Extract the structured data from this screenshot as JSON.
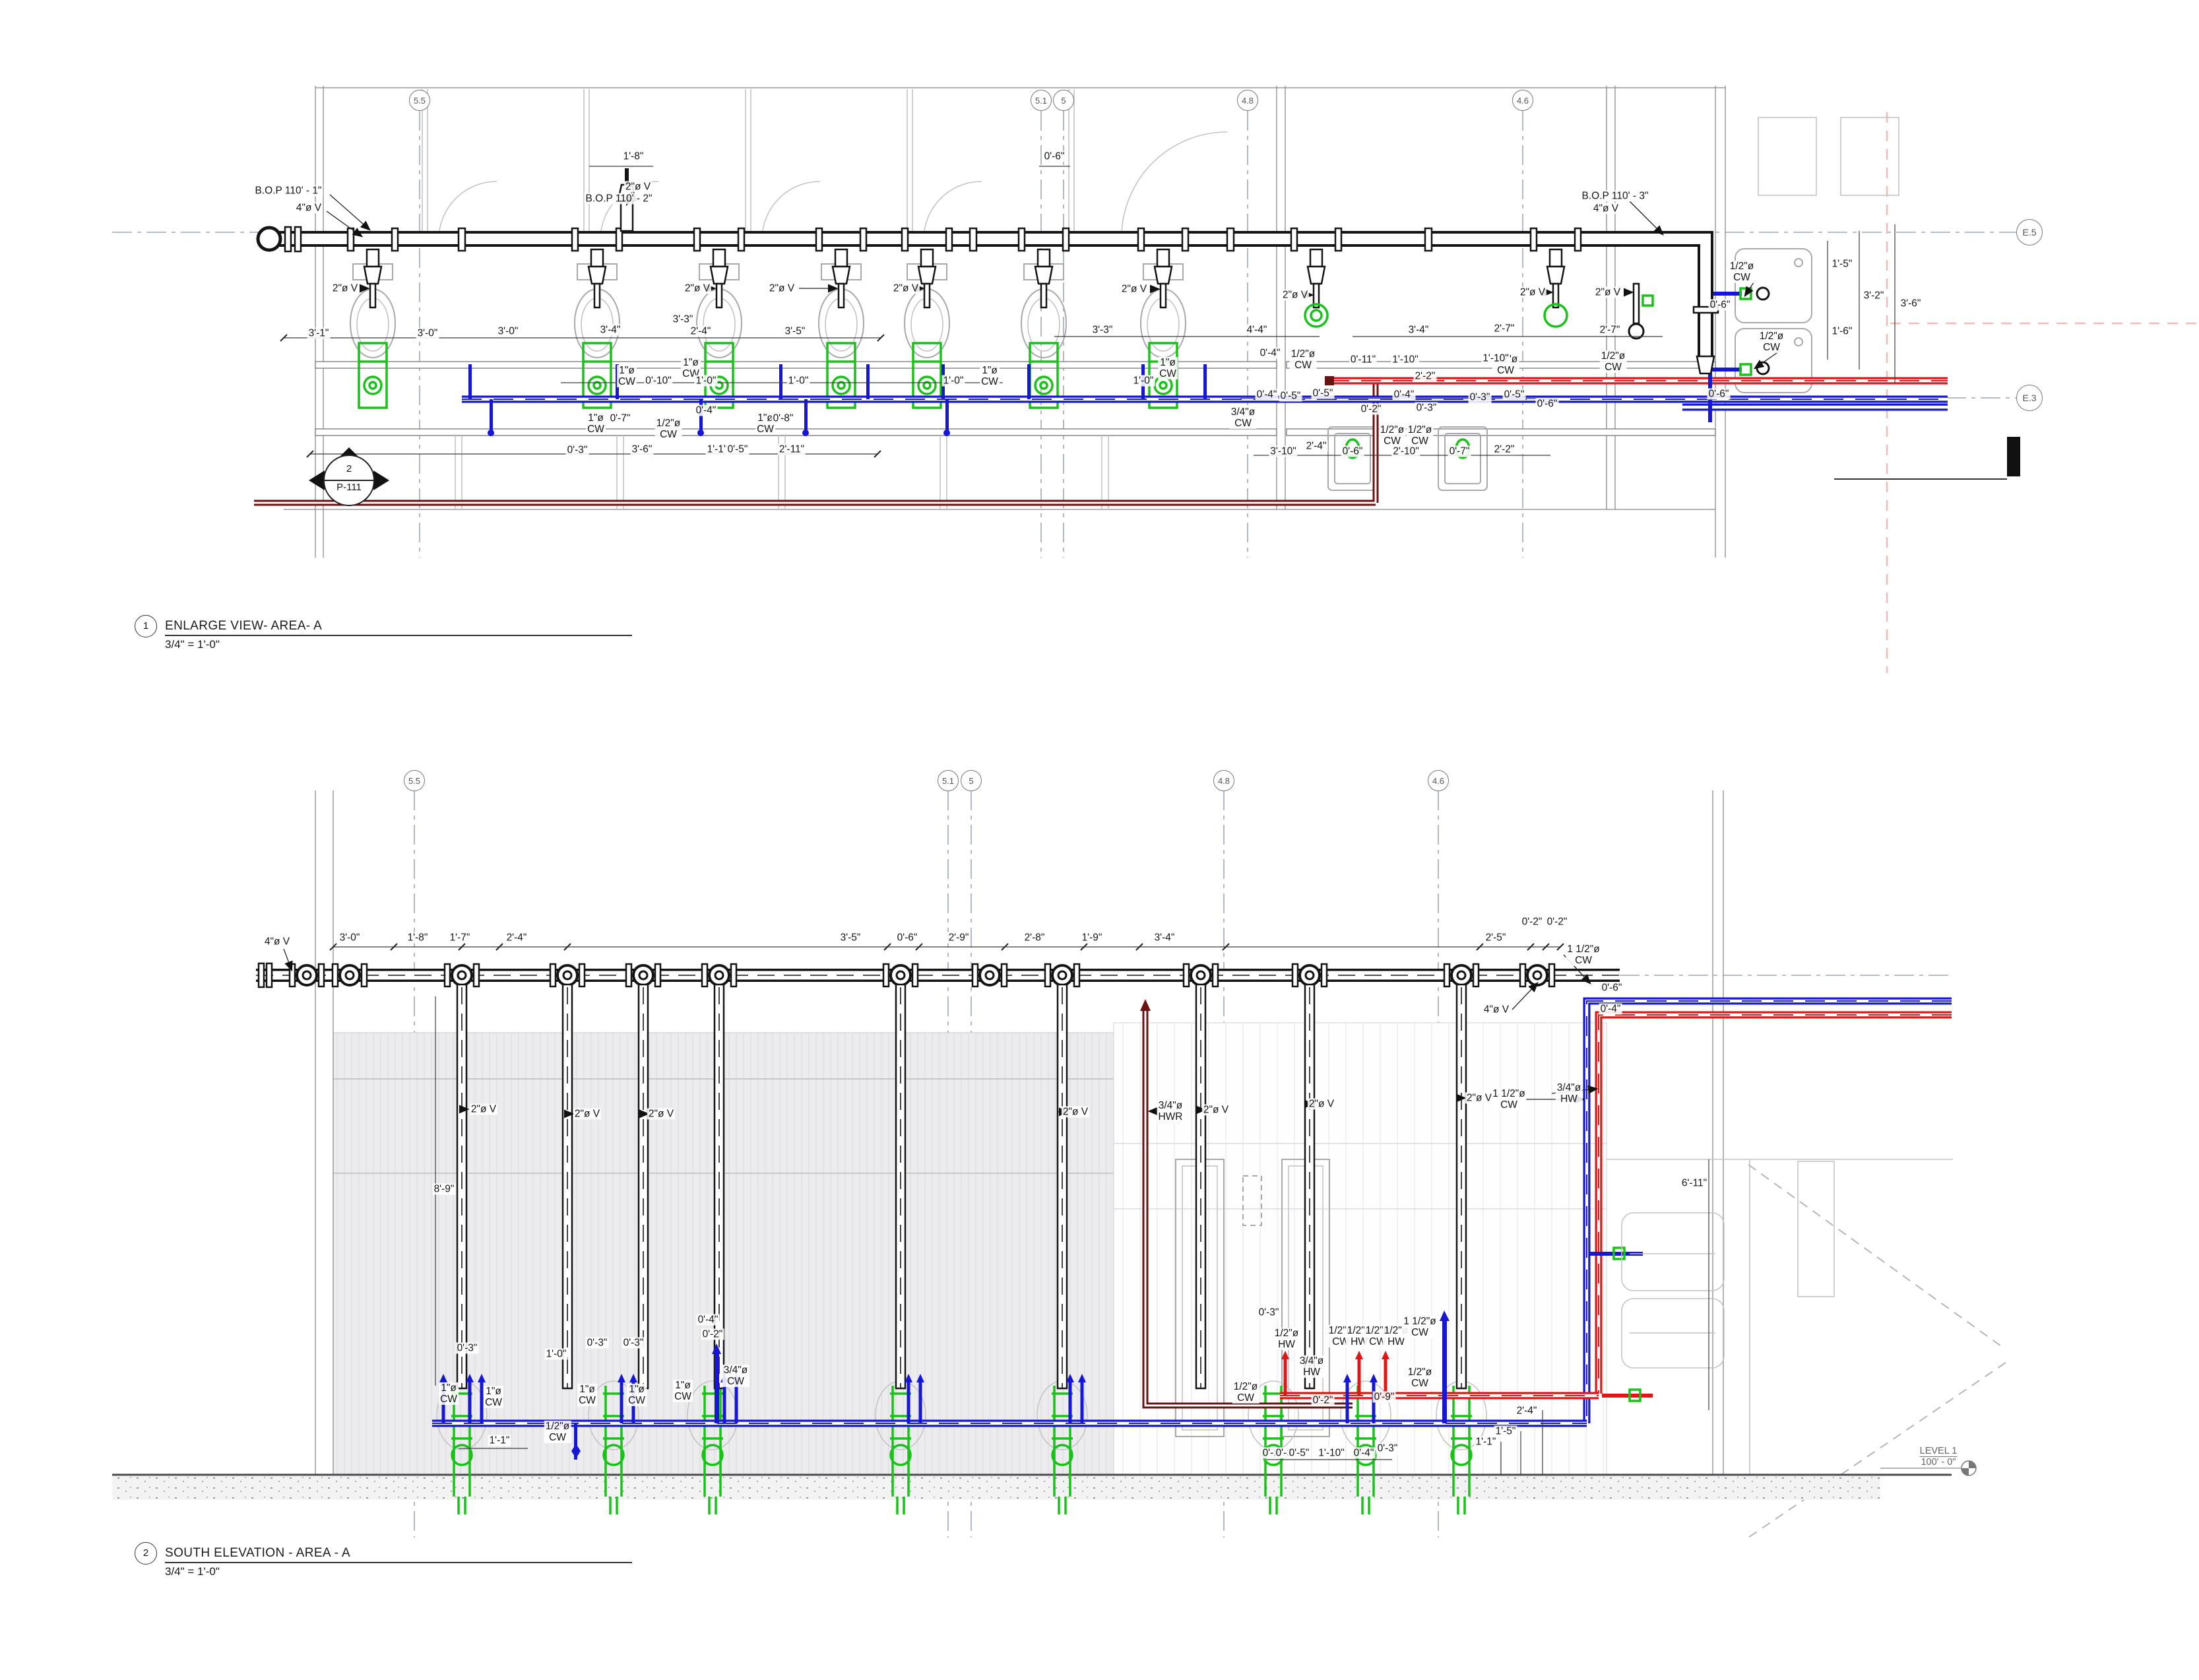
{
  "drawing": {
    "type": "plumbing-shop-drawing",
    "colors": {
      "cold_water": "#1616d6",
      "hot_water": "#e31616",
      "hot_water_return": "#6d1212",
      "vent": "#141414",
      "fixture_carrier": "#16c316",
      "grid": "#8a93a6"
    },
    "views": [
      {
        "id": "plan",
        "number": "1",
        "title": "ENLARGE VIEW- AREA- A",
        "scale": "3/4\" = 1'-0\"",
        "grid_bubbles": [
          [
            "5.5",
            636,
            152
          ],
          [
            "5.1",
            1578,
            152
          ],
          [
            "5",
            1612,
            152
          ],
          [
            "4.8",
            1891,
            152
          ],
          [
            "4.6",
            2308,
            152
          ],
          [
            "E.5",
            3076,
            352,
            19
          ],
          [
            "E.3",
            3076,
            603,
            19
          ]
        ],
        "section_tag": {
          "number": "2",
          "sheet": "P-111"
        },
        "labels": [
          [
            "B.O.P 110' - 1\"",
            437,
            289
          ],
          [
            "4\"ø V",
            468,
            315
          ],
          [
            "2\"ø V",
            523,
            437
          ],
          [
            "3'-1\"",
            483,
            505
          ],
          [
            "3'-0\"",
            648,
            505
          ],
          [
            "1'-8\"",
            960,
            237
          ],
          [
            "2\"ø V",
            967,
            283
          ],
          [
            "B.O.P 110' - 2\"",
            938,
            301
          ],
          [
            "2\"ø V",
            1057,
            437
          ],
          [
            "2\"ø V",
            1185,
            437
          ],
          [
            "2\"ø V",
            1373,
            437
          ],
          [
            "2\"ø V",
            1719,
            438
          ],
          [
            "2\"ø V",
            1963,
            447
          ],
          [
            "2\"ø V",
            2323,
            443
          ],
          [
            "2\"ø V",
            2437,
            443
          ],
          [
            "3'-0\"",
            770,
            502
          ],
          [
            "3'-4\"",
            925,
            500
          ],
          [
            "3'-3\"",
            1035,
            484
          ],
          [
            "2'-4\"",
            1062,
            502
          ],
          [
            "3'-5\"",
            1205,
            502
          ],
          [
            "0'-6\"",
            1598,
            237
          ],
          [
            "3'-3\"",
            1671,
            500
          ],
          [
            "4'-4\"",
            1905,
            500
          ],
          [
            "3'-4\"",
            2150,
            500
          ],
          [
            "2'-7\"",
            2280,
            498
          ],
          [
            "1\"ø\nCW",
            950,
            570
          ],
          [
            "0'-10\"",
            998,
            577
          ],
          [
            "1\"ø\nCW",
            1047,
            558
          ],
          [
            "1'-0\"",
            1070,
            577
          ],
          [
            "1'-0\"",
            1210,
            577
          ],
          [
            "1\"ø\nCW",
            1500,
            570
          ],
          [
            "1'-0\"",
            1445,
            577
          ],
          [
            "1\"ø\nCW",
            1770,
            558
          ],
          [
            "1'-0\"",
            1733,
            577
          ],
          [
            "1\"ø\nCW",
            903,
            642
          ],
          [
            "0'-7\"",
            940,
            634
          ],
          [
            "1/2\"ø\nCW",
            1013,
            650
          ],
          [
            "0'-4\"",
            1070,
            622
          ],
          [
            "1\"ø\nCW",
            1160,
            642
          ],
          [
            "0'-8\"",
            1187,
            634
          ],
          [
            "0'-3\"",
            875,
            682
          ],
          [
            "3'-6\"",
            973,
            681
          ],
          [
            "1'-1\"",
            1087,
            681
          ],
          [
            "0'-5\"",
            1118,
            681
          ],
          [
            "2'-11\"",
            1200,
            681
          ],
          [
            "0'-5\"",
            1956,
            600
          ],
          [
            "0'-4\"",
            1925,
            535
          ],
          [
            "1/2\"ø\nCW",
            1975,
            545
          ],
          [
            "0'-11\"",
            2066,
            545
          ],
          [
            "1'-10\"",
            2130,
            545
          ],
          [
            "2'-2\"",
            2160,
            570
          ],
          [
            "1/2\"ø\nCW",
            2282,
            553
          ],
          [
            "0'-4\"",
            1920,
            598
          ],
          [
            "0'-5\"",
            2005,
            596
          ],
          [
            "0'-4\"",
            2128,
            598
          ],
          [
            "0'-3\"",
            2243,
            602
          ],
          [
            "0'-5\"",
            2295,
            598
          ],
          [
            "0'-6\"",
            2345,
            612
          ],
          [
            "3/4\"ø\nCW",
            1884,
            633
          ],
          [
            "0'-2\"",
            2078,
            620
          ],
          [
            "0'-3\"",
            2162,
            618
          ],
          [
            "1/2\"ø\nCW",
            2110,
            660
          ],
          [
            "1/2\"ø\nCW",
            2152,
            660
          ],
          [
            "3'-10\"",
            1945,
            684
          ],
          [
            "2'-4\"",
            1995,
            676
          ],
          [
            "0'-6\"",
            2050,
            684
          ],
          [
            "2'-10\"",
            2131,
            684
          ],
          [
            "0'-7\"",
            2212,
            684
          ],
          [
            "2'-2\"",
            2280,
            681
          ],
          [
            "B.O.P 110' - 3\"",
            2448,
            297
          ],
          [
            "4\"ø V",
            2434,
            316
          ],
          [
            "2'-7\"",
            2440,
            500
          ],
          [
            "1'-10\"",
            2267,
            543
          ],
          [
            "1/2\"ø\nCW",
            2445,
            548
          ],
          [
            "1/2\"ø\nCW",
            2640,
            412
          ],
          [
            "1/2\"ø\nCW",
            2685,
            518
          ],
          [
            "1'-5\"",
            2792,
            400
          ],
          [
            "3'-2\"",
            2840,
            448
          ],
          [
            "3'-6\"",
            2896,
            460
          ],
          [
            "1'-6\"",
            2792,
            502
          ],
          [
            "0'-6\"",
            2607,
            462
          ],
          [
            "0'-6\"",
            2605,
            597
          ]
        ]
      },
      {
        "id": "elevation",
        "number": "2",
        "title": "SOUTH ELEVATION - AREA - A",
        "scale": "3/4\" = 1'-0\"",
        "grid_bubbles": [
          [
            "5.5",
            628,
            1183
          ],
          [
            "5.1",
            1437,
            1183
          ],
          [
            "5",
            1472,
            1183
          ],
          [
            "4.8",
            1855,
            1183
          ],
          [
            "4.6",
            2180,
            1183
          ]
        ],
        "level_tag": {
          "name": "LEVEL 1",
          "elevation": "100' - 0\""
        },
        "labels": [
          [
            "4\"ø V",
            420,
            1427
          ],
          [
            "3'-0\"",
            530,
            1421
          ],
          [
            "1'-8\"",
            633,
            1421
          ],
          [
            "1'-7\"",
            697,
            1421
          ],
          [
            "2'-4\"",
            783,
            1421
          ],
          [
            "3'-5\"",
            1289,
            1421
          ],
          [
            "0'-6\"",
            1375,
            1421
          ],
          [
            "2'-9\"",
            1453,
            1421
          ],
          [
            "2'-8\"",
            1568,
            1421
          ],
          [
            "1'-9\"",
            1655,
            1421
          ],
          [
            "3'-4\"",
            1765,
            1421
          ],
          [
            "2'-5\"",
            2267,
            1421
          ],
          [
            "0'-2\"",
            2322,
            1397
          ],
          [
            "0'-2\"",
            2360,
            1397
          ],
          [
            "1 1/2\"ø\nCW",
            2400,
            1447
          ],
          [
            "0'-6\"",
            2443,
            1497
          ],
          [
            "0'-4\"",
            2441,
            1529
          ],
          [
            "4\"ø V",
            2268,
            1530
          ],
          [
            "8'-9\"",
            673,
            1802
          ],
          [
            "2\"ø V",
            733,
            1681
          ],
          [
            "2\"ø V",
            890,
            1688
          ],
          [
            "2\"ø V",
            1002,
            1688
          ],
          [
            "2\"ø V",
            1630,
            1685
          ],
          [
            "3/4\"ø\nHWR",
            1774,
            1684
          ],
          [
            "2\"ø V",
            1843,
            1682
          ],
          [
            "2\"ø V",
            2003,
            1673
          ],
          [
            "2\"ø V",
            2242,
            1664
          ],
          [
            "1 1/2\"ø\nCW",
            2287,
            1666
          ],
          [
            "3/4\"ø\nHW",
            2378,
            1657
          ],
          [
            "6'-11\"",
            2568,
            1793
          ],
          [
            "0'-3\"",
            708,
            2043
          ],
          [
            "1'-0\"",
            843,
            2052
          ],
          [
            "0'-3\"",
            905,
            2035
          ],
          [
            "0'-3\"",
            960,
            2035
          ],
          [
            "0'-4\"",
            1073,
            2000
          ],
          [
            "0'-2\"",
            1080,
            2022
          ],
          [
            "1\"ø\nCW",
            680,
            2112
          ],
          [
            "1\"ø\nCW",
            748,
            2117
          ],
          [
            "1\"ø\nCW",
            890,
            2114
          ],
          [
            "1\"ø\nCW",
            965,
            2114
          ],
          [
            "1\"ø\nCW",
            1035,
            2108
          ],
          [
            "3/4\"ø\nCW",
            1115,
            2085
          ],
          [
            "1/2\"ø\nCW",
            845,
            2170
          ],
          [
            "1'-1\"",
            757,
            2183
          ],
          [
            "0'-3\"",
            1923,
            1989
          ],
          [
            "1/2\"ø\nHW",
            1950,
            2029
          ],
          [
            "3/4\"ø\nHW",
            1988,
            2071
          ],
          [
            "1/2\"ø\nCW",
            1888,
            2110
          ],
          [
            "1/2\"ø\nCW",
            2032,
            2025
          ],
          [
            "1/2\"ø\nHW",
            2060,
            2025
          ],
          [
            "1/2\"ø\nCW",
            2088,
            2025
          ],
          [
            "1/2\"ø\nHW",
            2116,
            2025
          ],
          [
            "1 1/2\"ø\nCW",
            2152,
            2011
          ],
          [
            "1/2\"ø\nCW",
            2152,
            2088
          ],
          [
            "0'-9\"",
            2098,
            2117
          ],
          [
            "0'-2\"",
            2005,
            2122
          ],
          [
            "2'-4\"",
            2314,
            2138
          ],
          [
            "1'-5\"",
            2282,
            2169
          ],
          [
            "1'-1\"",
            2252,
            2185
          ],
          [
            "0'-2\"",
            1929,
            2202
          ],
          [
            "0'-3\"",
            1949,
            2202
          ],
          [
            "0'-5\"",
            1969,
            2202
          ],
          [
            "1'-10\"",
            2018,
            2202
          ],
          [
            "0'-4\"",
            2067,
            2202
          ],
          [
            "0'-3\"",
            2103,
            2195
          ]
        ]
      }
    ]
  }
}
